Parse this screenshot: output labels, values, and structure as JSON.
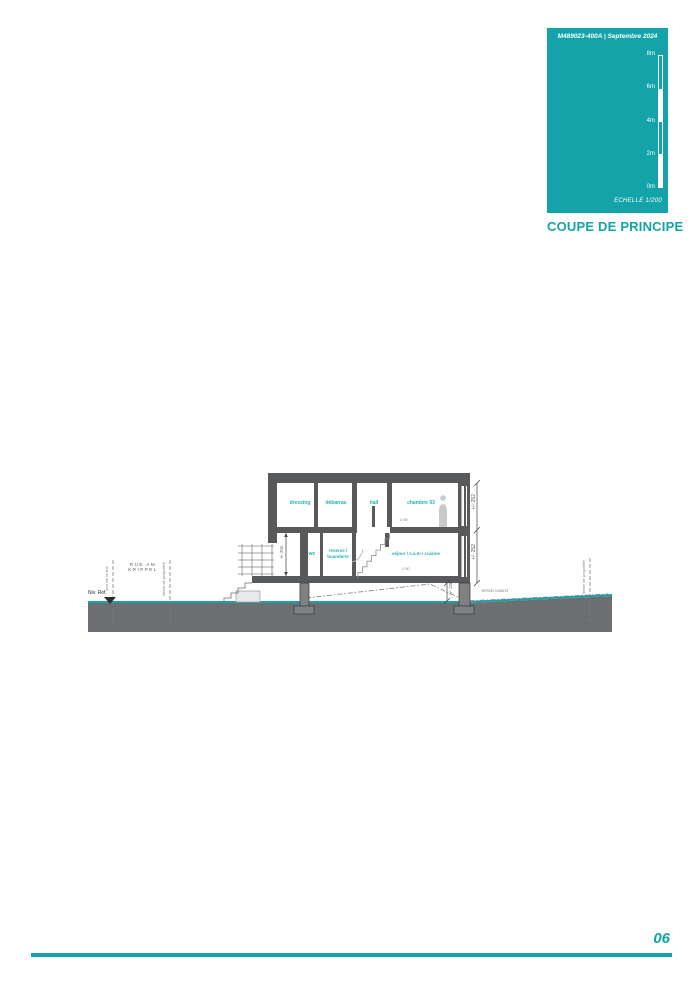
{
  "title_block": {
    "ref": "M489023-400A | Septembre 2024",
    "scale_ticks": [
      "8m",
      "6m",
      "4m",
      "2m",
      "0m"
    ],
    "scale_label": "ECHELLE 1/200",
    "title": "COUPE DE PRINCIPE"
  },
  "section": {
    "street_label": "RUE AM KRIPPEL",
    "level_reference": "Niv. Réf.",
    "axis_line_label": "axe de la rue",
    "property_limit_left": "limite de propriété",
    "property_limit_right": "limite de propriété",
    "terrain_label": "terrain naturel",
    "rooms": {
      "dressing": "dressing",
      "debarras": "débarras",
      "hall": "hall",
      "chambre": "chambre 03",
      "wc": "wc",
      "reserve_buanderie": "réserve / buanderie",
      "sejour": "séjour / s.à.m / cuisine"
    },
    "dimensions": {
      "upper_storey": "+/- 252",
      "ground_storey": "+/- 252",
      "entry_height": "+/- 204",
      "pilotis_height": "+/- 131",
      "upper_clear_height": "2.50",
      "ground_clear_height": "2.50"
    }
  },
  "footer": {
    "page_number": "06"
  },
  "colors": {
    "teal": "#14a3a8",
    "room_label_teal": "#1fb2b6",
    "wall_gray": "#58595b",
    "ground_gray": "#6d6e71"
  }
}
